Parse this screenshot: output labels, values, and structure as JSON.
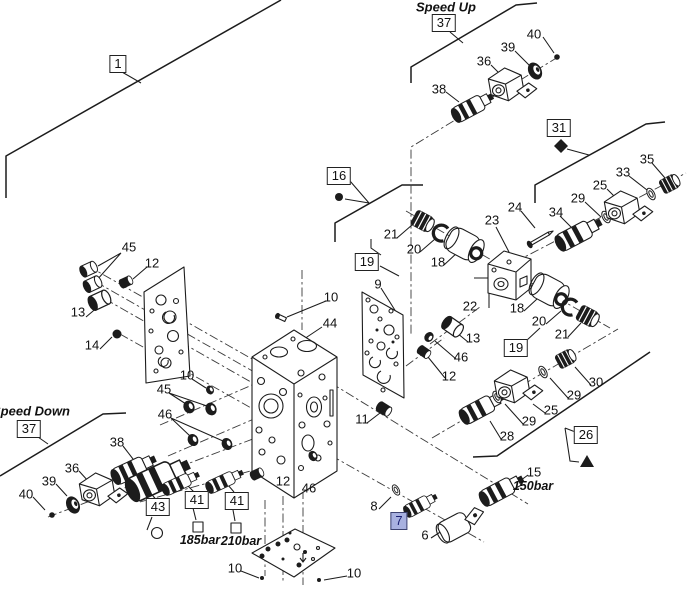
{
  "figure": {
    "background": "#ffffff",
    "line_color": "#1c1c1c",
    "highlight_fill": "#a8b1e0",
    "highlight_text": "#1a1f71"
  },
  "annotations": {
    "speed_up": "Speed Up",
    "speed_down": "Speed Down",
    "pressure_150": "150bar",
    "pressure_185": "185bar",
    "pressure_210": "210bar"
  },
  "boxed_callouts": [
    {
      "label": "1",
      "x": 118,
      "y": 64
    },
    {
      "label": "37",
      "x": 444,
      "y": 23
    },
    {
      "label": "31",
      "x": 559,
      "y": 128
    },
    {
      "label": "16",
      "x": 339,
      "y": 176
    },
    {
      "label": "19",
      "x": 367,
      "y": 262
    },
    {
      "label": "19",
      "x": 516,
      "y": 348
    },
    {
      "label": "26",
      "x": 586,
      "y": 435
    },
    {
      "label": "37",
      "x": 29,
      "y": 429
    },
    {
      "label": "43",
      "x": 158,
      "y": 507
    },
    {
      "label": "41",
      "x": 197,
      "y": 500
    },
    {
      "label": "41",
      "x": 237,
      "y": 501
    },
    {
      "label": "7",
      "x": 399,
      "y": 521,
      "highlight": true
    }
  ],
  "callouts": [
    {
      "label": "40",
      "x": 534,
      "y": 34
    },
    {
      "label": "39",
      "x": 508,
      "y": 47
    },
    {
      "label": "36",
      "x": 484,
      "y": 61
    },
    {
      "label": "38",
      "x": 439,
      "y": 89
    },
    {
      "label": "35",
      "x": 647,
      "y": 159
    },
    {
      "label": "33",
      "x": 623,
      "y": 172
    },
    {
      "label": "25",
      "x": 600,
      "y": 185
    },
    {
      "label": "29",
      "x": 578,
      "y": 198
    },
    {
      "label": "24",
      "x": 515,
      "y": 207
    },
    {
      "label": "34",
      "x": 556,
      "y": 212
    },
    {
      "label": "23",
      "x": 492,
      "y": 220
    },
    {
      "label": "21",
      "x": 391,
      "y": 234
    },
    {
      "label": "20",
      "x": 414,
      "y": 249
    },
    {
      "label": "18",
      "x": 438,
      "y": 262
    },
    {
      "label": "9",
      "x": 378,
      "y": 284
    },
    {
      "label": "10",
      "x": 331,
      "y": 297
    },
    {
      "label": "22",
      "x": 470,
      "y": 306
    },
    {
      "label": "18",
      "x": 517,
      "y": 308
    },
    {
      "label": "20",
      "x": 539,
      "y": 321
    },
    {
      "label": "21",
      "x": 562,
      "y": 334
    },
    {
      "label": "45",
      "x": 129,
      "y": 247
    },
    {
      "label": "12",
      "x": 152,
      "y": 263
    },
    {
      "label": "13",
      "x": 78,
      "y": 312
    },
    {
      "label": "14",
      "x": 92,
      "y": 345
    },
    {
      "label": "44",
      "x": 330,
      "y": 323
    },
    {
      "label": "30",
      "x": 596,
      "y": 382
    },
    {
      "label": "29",
      "x": 574,
      "y": 395
    },
    {
      "label": "25",
      "x": 551,
      "y": 410
    },
    {
      "label": "29",
      "x": 529,
      "y": 421
    },
    {
      "label": "28",
      "x": 507,
      "y": 436
    },
    {
      "label": "13",
      "x": 473,
      "y": 338
    },
    {
      "label": "46",
      "x": 461,
      "y": 357
    },
    {
      "label": "12",
      "x": 449,
      "y": 376
    },
    {
      "label": "10",
      "x": 187,
      "y": 375
    },
    {
      "label": "45",
      "x": 164,
      "y": 389
    },
    {
      "label": "46",
      "x": 165,
      "y": 414
    },
    {
      "label": "11",
      "x": 362,
      "y": 419
    },
    {
      "label": "38",
      "x": 117,
      "y": 442
    },
    {
      "label": "36",
      "x": 72,
      "y": 468
    },
    {
      "label": "39",
      "x": 49,
      "y": 481
    },
    {
      "label": "40",
      "x": 26,
      "y": 494
    },
    {
      "label": "12",
      "x": 283,
      "y": 481
    },
    {
      "label": "46",
      "x": 309,
      "y": 488
    },
    {
      "label": "10",
      "x": 235,
      "y": 568
    },
    {
      "label": "10",
      "x": 354,
      "y": 573
    },
    {
      "label": "15",
      "x": 534,
      "y": 472
    },
    {
      "label": "8",
      "x": 374,
      "y": 506
    },
    {
      "label": "6",
      "x": 425,
      "y": 535
    }
  ]
}
